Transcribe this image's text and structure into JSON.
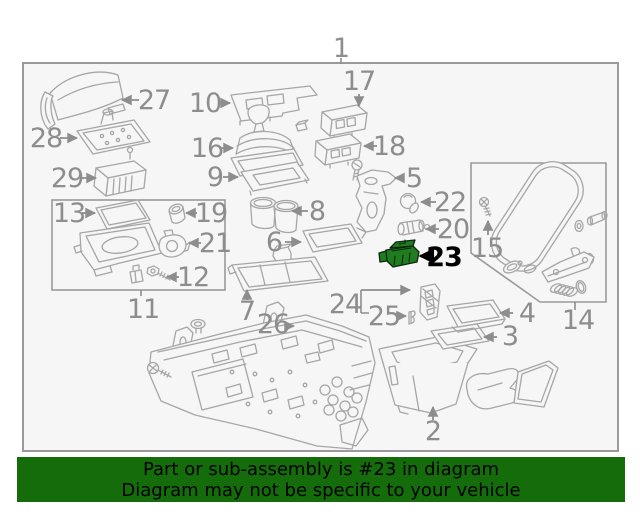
{
  "banner": {
    "line1": "Part or sub-assembly is #23 in diagram",
    "line2": "Diagram may not be specific to your vehicle",
    "background_color": "#146c0a",
    "text_color": "#000000"
  },
  "diagram": {
    "type": "exploded-parts-diagram",
    "subject": "vehicle center console assembly",
    "highlighted_part_number": "23",
    "highlight_part_color": "#1f7d1f",
    "highlight_label_color": "#000000",
    "label_color": "#8d8d8d",
    "line_color": "#a6a6a6",
    "callouts": {
      "c1": "1",
      "c2": "2",
      "c3": "3",
      "c4": "4",
      "c5": "5",
      "c6": "6",
      "c7": "7",
      "c8": "8",
      "c9": "9",
      "c10": "10",
      "c11": "11",
      "c12": "12",
      "c13": "13",
      "c14": "14",
      "c15": "15",
      "c16": "16",
      "c17": "17",
      "c18": "18",
      "c19": "19",
      "c20": "20",
      "c21": "21",
      "c22": "22",
      "c23": "23",
      "c24": "24",
      "c25": "25",
      "c26": "26",
      "c27": "27",
      "c28": "28",
      "c29": "29"
    }
  }
}
